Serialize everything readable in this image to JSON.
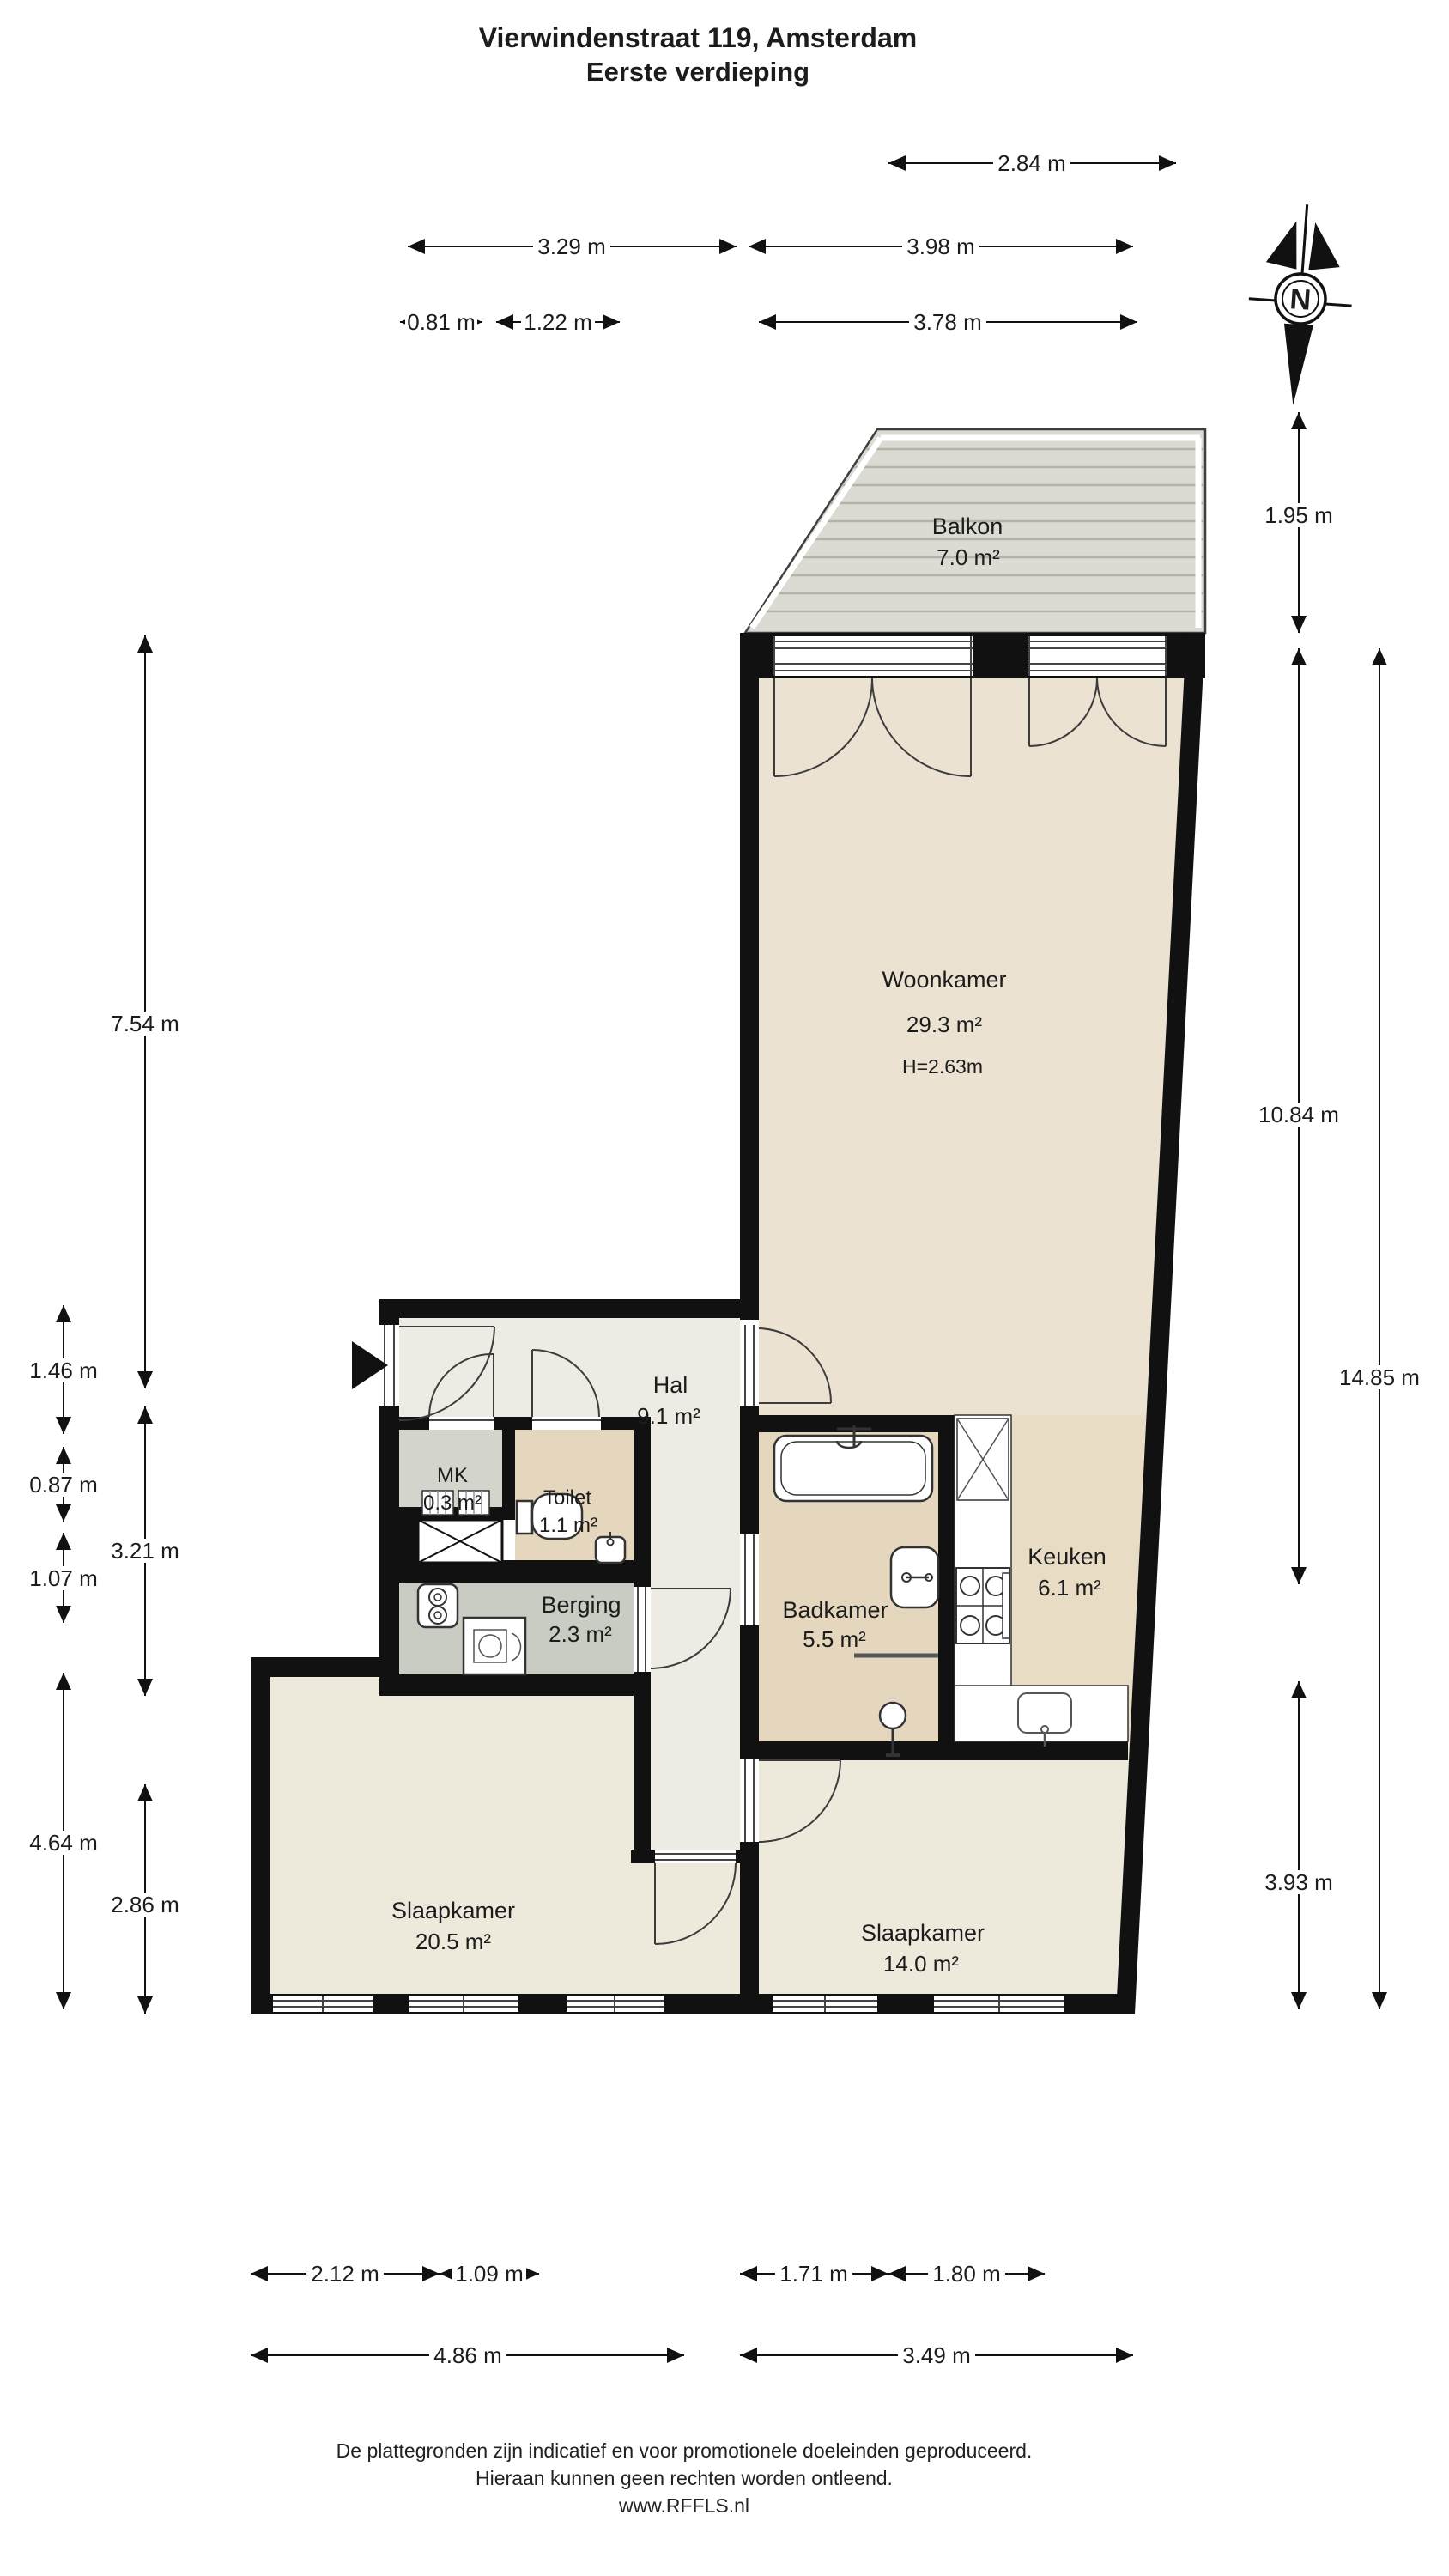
{
  "title": {
    "line1": "Vierwindenstraat 119, Amsterdam",
    "line2": "Eerste verdieping"
  },
  "compass": {
    "label": "N"
  },
  "rooms": [
    {
      "name": "Balkon",
      "area": "7.0 m²"
    },
    {
      "name": "Woonkamer",
      "area": "29.3 m²",
      "height": "H=2.63m"
    },
    {
      "name": "Hal",
      "area": "9.1 m²"
    },
    {
      "name": "MK",
      "area": "0.3 m²"
    },
    {
      "name": "Toilet",
      "area": "1.1 m²"
    },
    {
      "name": "Berging",
      "area": "2.3 m²"
    },
    {
      "name": "Badkamer",
      "area": "5.5 m²"
    },
    {
      "name": "Keuken",
      "area": "6.1 m²"
    },
    {
      "name": "Slaapkamer",
      "area": "20.5 m²"
    },
    {
      "name": "Slaapkamer",
      "area": "14.0 m²"
    }
  ],
  "dims": {
    "w284": "2.84 m",
    "w329": "3.29 m",
    "w398": "3.98 m",
    "w081": "0.81 m",
    "w122": "1.22 m",
    "w378": "3.78 m",
    "h195": "1.95 m",
    "h1084": "10.84 m",
    "h1485": "14.85 m",
    "h393": "3.93 m",
    "h754": "7.54 m",
    "h321": "3.21 m",
    "h286": "2.86 m",
    "h146": "1.46 m",
    "h087": "0.87 m",
    "h107": "1.07 m",
    "h464": "4.64 m",
    "b212": "2.12 m",
    "b109": "1.09 m",
    "b171": "1.71 m",
    "b180": "1.80 m",
    "b486": "4.86 m",
    "b349": "3.49 m"
  },
  "footer": {
    "line1": "De plattegronden zijn indicatief en voor promotionele doeleinden geproduceerd.",
    "line2": "Hieraan kunnen geen rechten worden ontleend.",
    "line3": "www.RFFLS.nl"
  },
  "colors": {
    "wall": "#111111",
    "floor_living": "#EBE2D2",
    "floor_kitchen": "#E8DCC5",
    "floor_bath": "#E5D6BE",
    "floor_bedroom": "#EDE9DB",
    "floor_hall": "#EDEBE3",
    "floor_mk": "#D3D4CB",
    "floor_storage": "#C9CCC3",
    "balcony_deck": "#DBDBD3"
  }
}
